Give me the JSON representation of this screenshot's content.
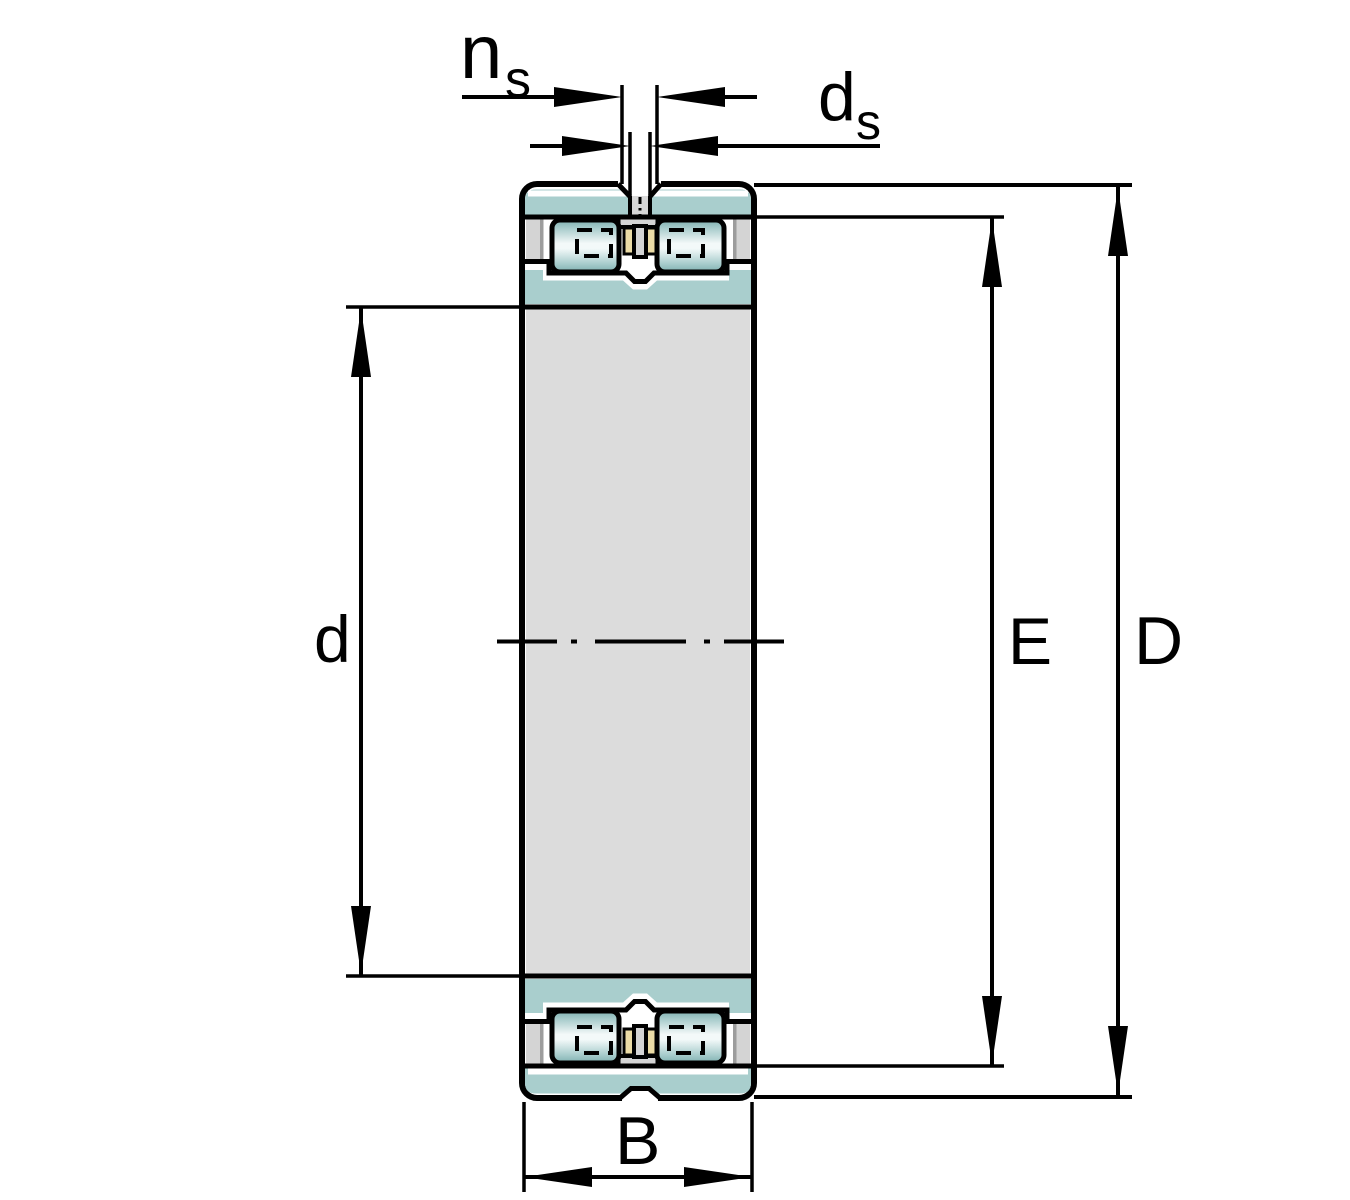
{
  "drawing": {
    "kind": "engineering-section-drawing",
    "subject": "double-row-cylindrical-roller-bearing-cross-section",
    "labels": {
      "lube_groove_width_main": "n",
      "lube_groove_width_sub": "s",
      "lube_hole_diameter_main": "d",
      "lube_hole_diameter_sub": "s",
      "bore_diameter": "d",
      "raceway_diameter": "E",
      "outside_diameter": "D",
      "width": "B"
    },
    "colors": {
      "background": "#ffffff",
      "outline": "#000000",
      "ring_teal": "#a9cecd",
      "bore_gray": "#dcdcdc",
      "recess_gray": "#d4d4d4",
      "recess_shadow_gray": "#9d9d9d",
      "hole_gray": "#d8d8d8",
      "cage_yellow": "#ecdca6",
      "roller_edge_teal": "#7fb0b0",
      "roller_highlight": "#f3f9f9"
    }
  }
}
